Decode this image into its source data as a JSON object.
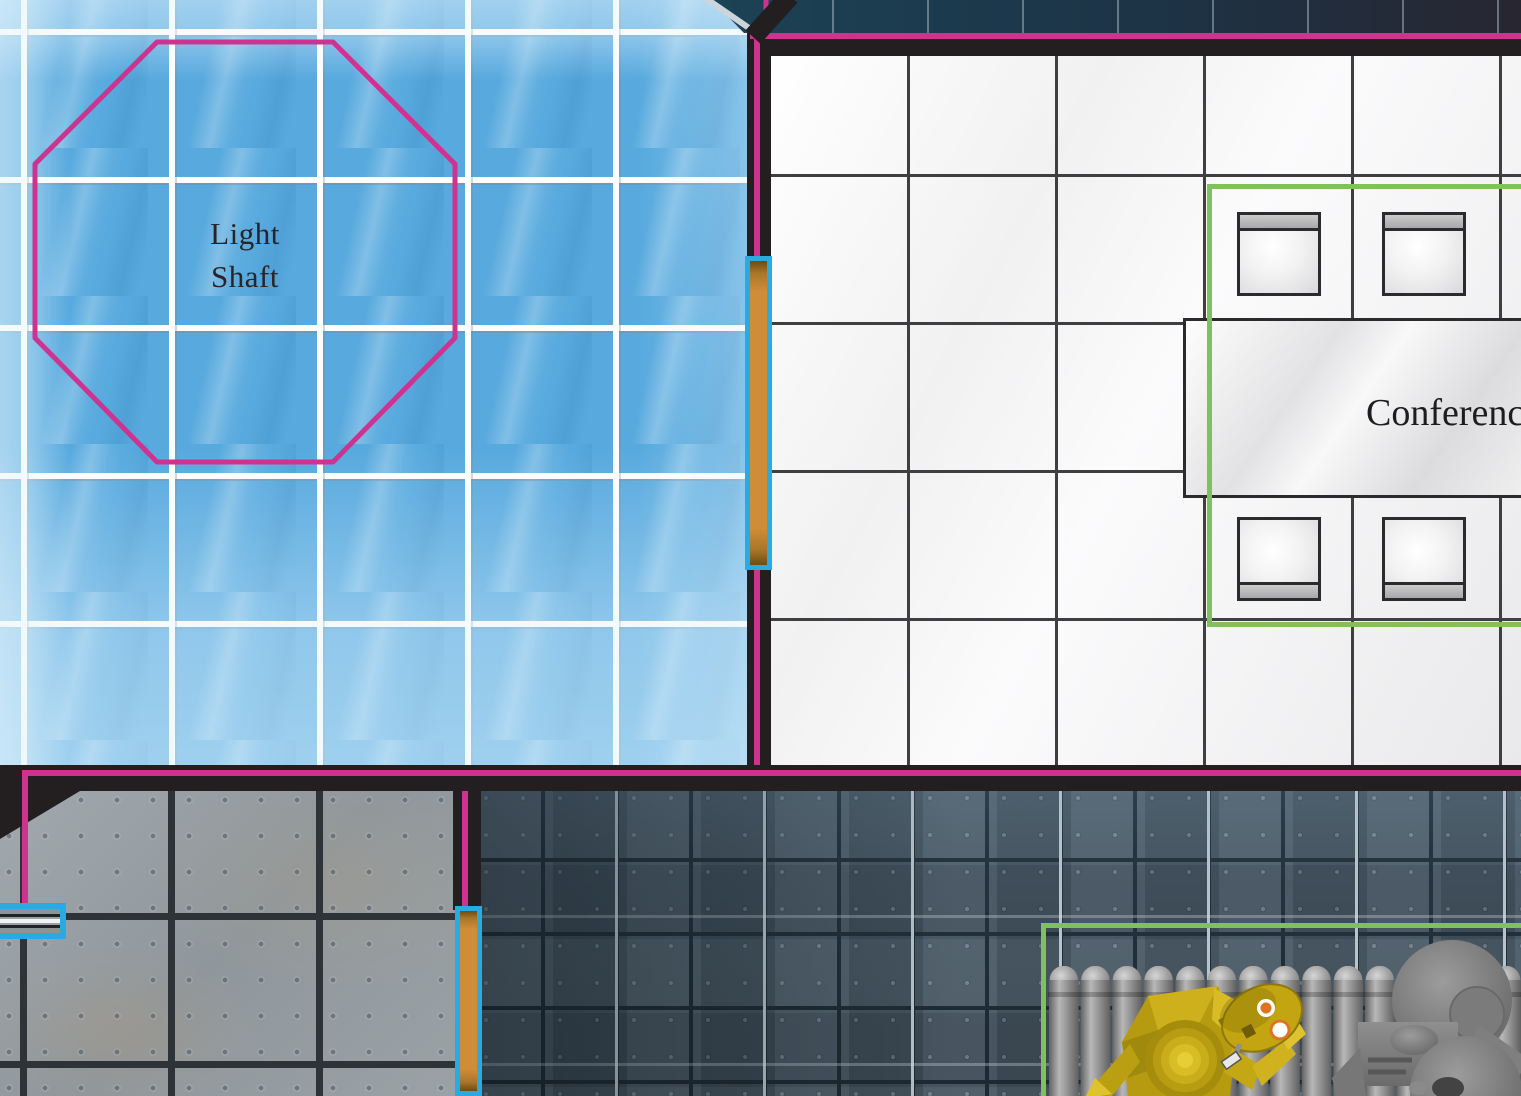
{
  "map": {
    "light_shaft_label": "Light\nShaft",
    "conference_table_label": "Conference"
  },
  "legend_colors": {
    "wall_outline_magenta": "#cf3390",
    "door_frame_cyan": "#29abe2",
    "door_fill_orange": "#d18c37",
    "area_highlight_green": "#7ec15e",
    "skylight_blue": "#57a9de",
    "wall_black": "#231f20",
    "room_floor_white": "#f2f2f3",
    "stone_floor_gray": "#98a0a5",
    "metal_floor_dark": "#41505c",
    "protocol_droid_yellow": "#c3a511",
    "utility_robot_gray": "#7d7d7d"
  },
  "tokens": [
    {
      "name": "protocol-droid-token"
    },
    {
      "name": "gray-utility-robot-token"
    }
  ]
}
